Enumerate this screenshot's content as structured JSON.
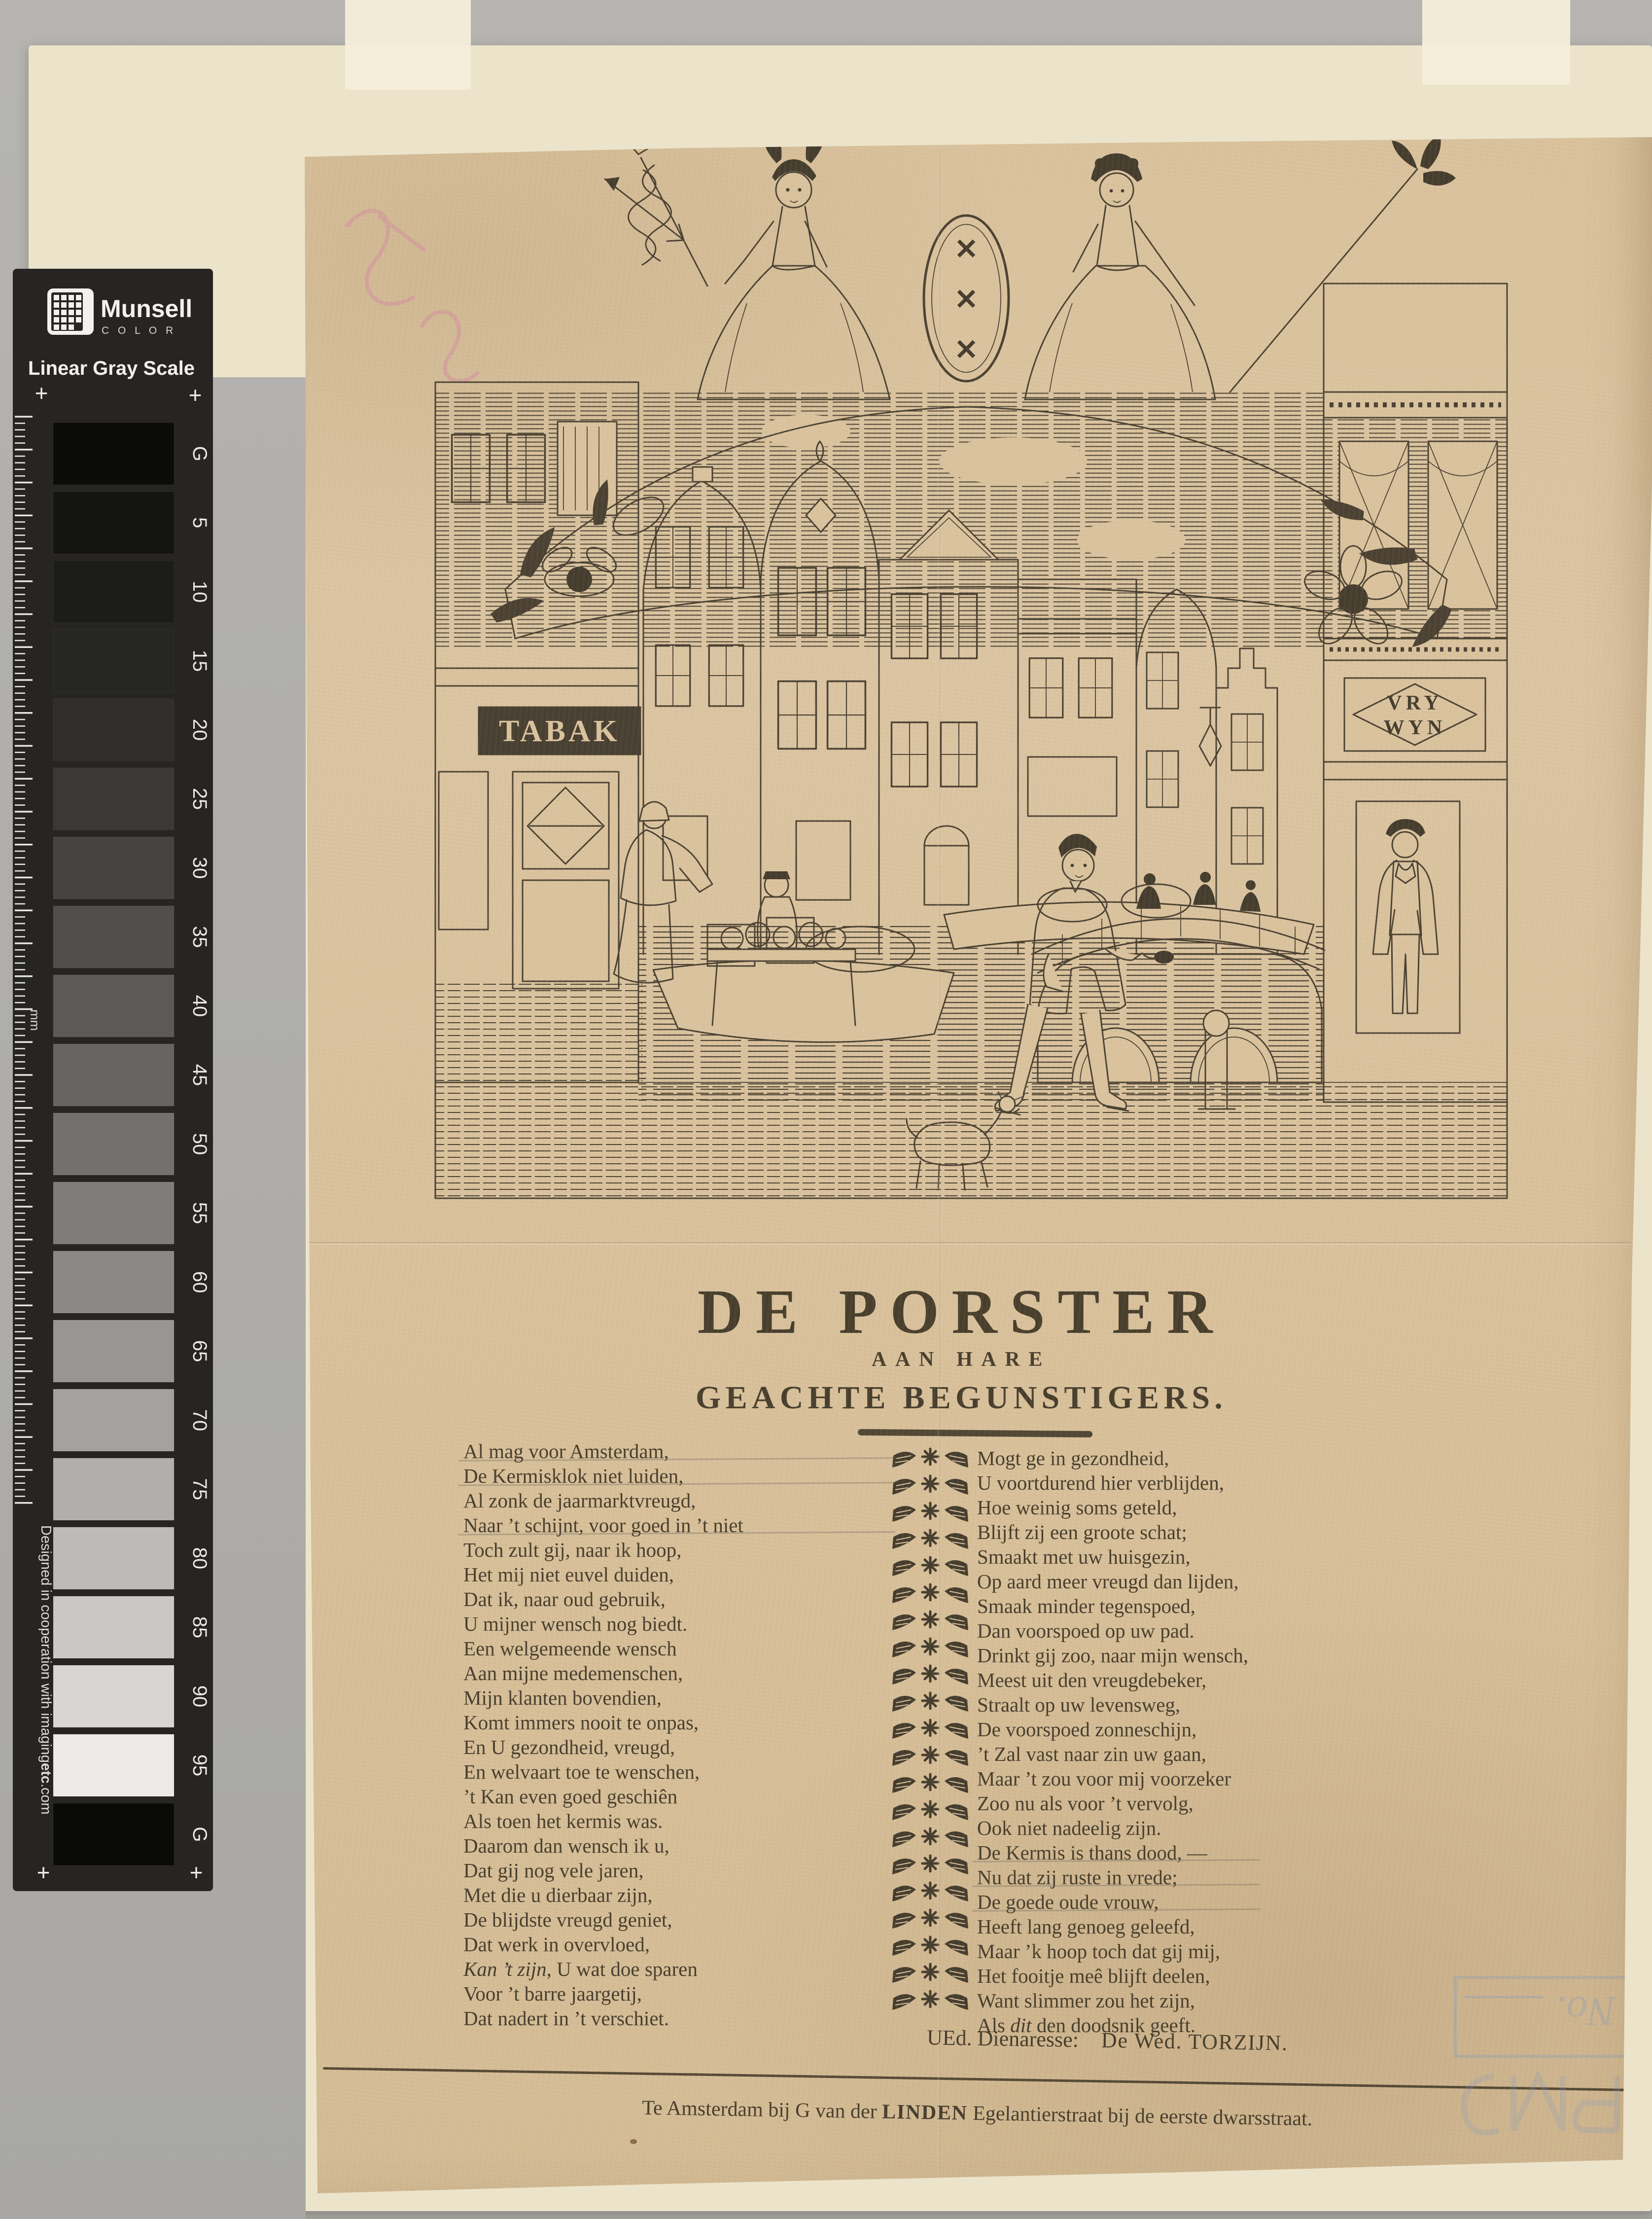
{
  "scan": {
    "munsell": {
      "brand": "Munsell",
      "brand_sub": "C O L O R",
      "scale_title": "Linear Gray Scale",
      "unit_label": "mm",
      "plus": "+",
      "credit_pre": "Designed in cooperation with imaging",
      "credit_bold": "etc",
      "credit_post": ".com",
      "patches": [
        {
          "label": "G",
          "color": "#0b0b0a"
        },
        {
          "label": "5",
          "color": "#141413"
        },
        {
          "label": "10",
          "color": "#1c1c1b"
        },
        {
          "label": "15",
          "color": "#262625"
        },
        {
          "label": "20",
          "color": "#302f2e"
        },
        {
          "label": "25",
          "color": "#3a3938"
        },
        {
          "label": "30",
          "color": "#454443"
        },
        {
          "label": "35",
          "color": "#504f4d"
        },
        {
          "label": "40",
          "color": "#5b5a58"
        },
        {
          "label": "45",
          "color": "#666563"
        },
        {
          "label": "50",
          "color": "#72716f"
        },
        {
          "label": "55",
          "color": "#7e7d7b"
        },
        {
          "label": "60",
          "color": "#8a8987"
        },
        {
          "label": "65",
          "color": "#979694"
        },
        {
          "label": "70",
          "color": "#a3a2a0"
        },
        {
          "label": "75",
          "color": "#b0afad"
        },
        {
          "label": "80",
          "color": "#bcbbb9"
        },
        {
          "label": "85",
          "color": "#c9c8c6"
        },
        {
          "label": "90",
          "color": "#d7d6d4"
        },
        {
          "label": "95",
          "color": "#eceae7"
        },
        {
          "label": "G",
          "color": "#0a0a09"
        }
      ]
    },
    "stamp_text": "No."
  },
  "broadside": {
    "illustration": {
      "sign_left": "TABAK",
      "sign_right_line1": "VRY",
      "sign_right_line2": "WYN",
      "shield_mark": "✕"
    },
    "title": "DE PORSTER",
    "subtitle1": "AAN HARE",
    "subtitle2": "GEACHTE  BEGUNSTIGERS.",
    "poem": {
      "left": [
        "Al mag voor Amsterdam,",
        "De Kermisklok niet luiden,",
        "Al zonk de jaarmarktvreugd,",
        "Naar ’t schijnt, voor goed in ’t niet",
        "Toch zult gij, naar ik hoop,",
        "Het mij niet euvel duiden,",
        "Dat ik, naar oud gebruik,",
        "U mijner wensch nog biedt.",
        "Een welgemeende wensch",
        "Aan mijne medemenschen,",
        "Mijn klanten bovendien,",
        "Komt immers nooit te onpas,",
        "En U gezondheid, vreugd,",
        "En welvaart toe te wenschen,",
        "’t Kan even goed geschiên",
        "Als toen het kermis was.",
        "Daarom dan wensch ik u,",
        "Dat gij nog vele jaren,",
        "Met die u dierbaar zijn,",
        "De blijdste vreugd geniet,",
        "Dat werk in overvloed,",
        "*Kan ’t zijn*, U wat doe sparen",
        "Voor ’t barre jaargetij,",
        "Dat nadert in ’t verschiet."
      ],
      "pencil_left": [
        0,
        1,
        3
      ],
      "right": [
        "Mogt ge in gezondheid,",
        "U voortdurend hier verblijden,",
        "Hoe weinig soms geteld,",
        "Blijft zij een groote schat;",
        "Smaakt met uw huisgezin,",
        "Op aard meer vreugd dan lijden,",
        "Smaak minder tegenspoed,",
        "Dan voorspoed op uw pad.",
        "Drinkt gij zoo, naar mijn wensch,",
        "Meest uit den vreugdebeker,",
        "Straalt op uw levensweg,",
        "De voorspoed zonneschijn,",
        "’t Zal vast naar zin uw gaan,",
        "Maar ’t zou voor mij voorzeker",
        "Zoo nu als voor ’t vervolg,",
        "Ook niet nadeelig zijn.",
        "De Kermis is thans dood, —",
        "Nu dat zij ruste in vrede;",
        "De goede oude vrouw,",
        "Heeft lang genoeg geleefd,",
        "Maar ’k hoop toch dat gij mij,",
        "Het fooitje meê blijft deelen,",
        "Want slimmer zou het zijn,",
        "Als *dit* den doodsnik geeft."
      ],
      "pencil_right": [
        16,
        17,
        18
      ]
    },
    "signature": {
      "salutation": "UEd. Dienaresse:",
      "name": "De Wed. TORZIJN."
    },
    "imprint": {
      "pre": "Te Amsterdam bij G van der ",
      "bold": "LINDEN",
      "post": " Egelantierstraat bij de eerste dwarsstraat."
    }
  }
}
